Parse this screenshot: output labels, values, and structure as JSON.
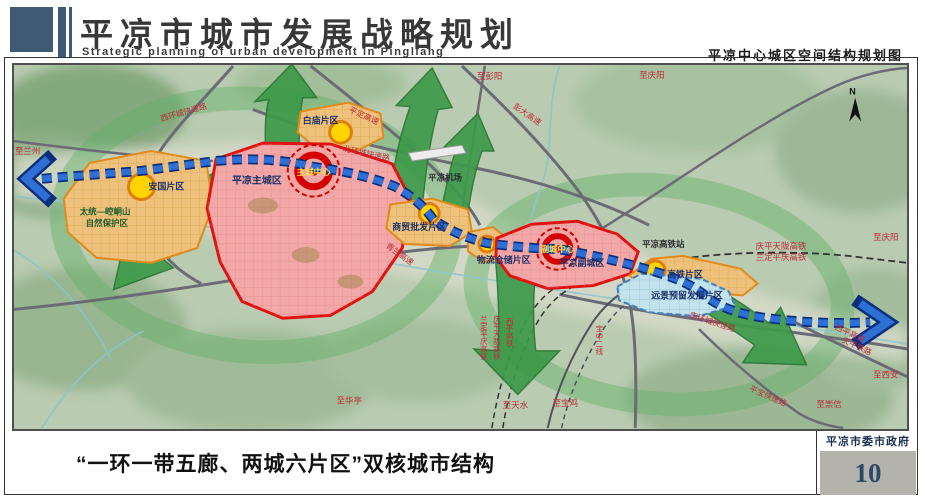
{
  "header": {
    "title": "平凉市城市发展战略规划",
    "title_en": "Strategic planning of urban development in Pingliang",
    "map_title": "平凉中心城区空间结构规划图"
  },
  "footer": {
    "caption": "“一环一带五廊、两城六片区”双核城市结构",
    "agency": "平凉市委市政府",
    "page_number": "10"
  },
  "map": {
    "compass": "N",
    "cities": [
      {
        "name": "平凉主城区",
        "center_label": "主城中心"
      },
      {
        "name": "平凉副城区",
        "center_label": "副城中心"
      }
    ],
    "districts": [
      "安国片区",
      "白庙片区",
      "商贸批发片区",
      "物流仓储片区",
      "高铁片区",
      "远景预留发展片区"
    ],
    "facilities": [
      "平凉机场",
      "平凉高铁站"
    ],
    "nature_reserve": {
      "line1": "太统—崆峒山",
      "line2": "自然保护区"
    },
    "roads": [
      "西环城快速路",
      "北环城快速路",
      "平定高速",
      "彭大高速",
      "青兰高速",
      "南环城快速路",
      "平宝快速路",
      "西平高速"
    ],
    "railways": [
      "庆平天陇高铁",
      "兰定平庆高铁",
      "西平高铁",
      "宝中二线",
      "天平铁路"
    ],
    "destinations": [
      "至兰州",
      "至彭阳",
      "至庆阳",
      "至西安",
      "至崇信",
      "至华亭",
      "至天水",
      "至宝鸡"
    ]
  },
  "colors": {
    "header_slate": "#3f5a73",
    "red_zone_border": "#e01111",
    "orange_zone_border": "#e08a1c",
    "node_yellow": "#ffd400",
    "belt_blue": "#2e6fd6",
    "corridor_green": "#3d9a49",
    "label_red": "#bf2a38",
    "label_navy": "#1c3068",
    "page_num_bg": "#b3b3ab",
    "page_num_color": "#2c4a68"
  }
}
